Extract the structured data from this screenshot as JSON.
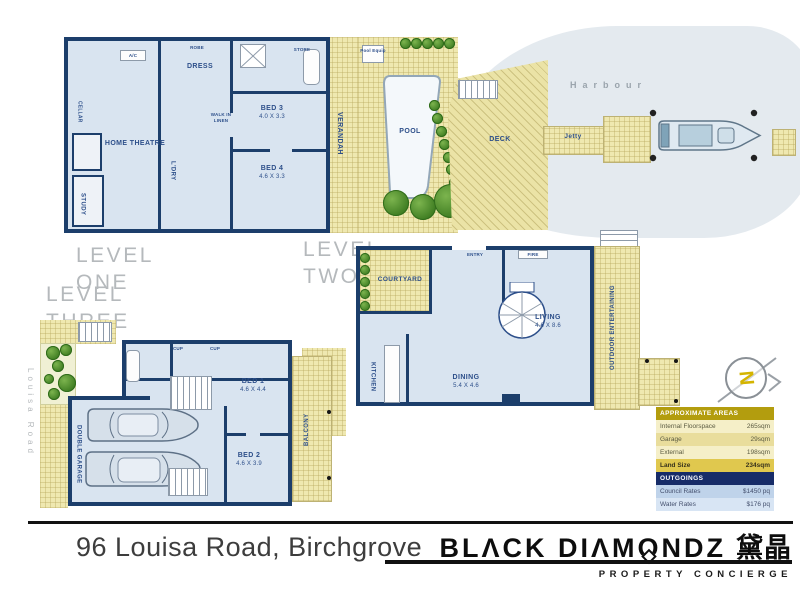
{
  "levels": {
    "one": {
      "caption": [
        "LEVEL",
        "ONE"
      ],
      "rooms": {
        "home_theatre": "HOME THEATRE",
        "study": "STUDY",
        "cellar": "CELLAR",
        "dress": "DRESS",
        "robe": "ROBE",
        "laundry": "L'DRY",
        "walk_in_linen": "WALK IN LINEN",
        "bed3": "BED 3",
        "bed3_dims": "4.0 X 3.3",
        "bed4": "BED 4",
        "bed4_dims": "4.6 X 3.3",
        "store": "STORE",
        "ac": "A/C"
      },
      "outdoor": {
        "verandah": "VERANDAH",
        "pool": "POOL",
        "pool_equip": "Pool Equip",
        "deck": "DECK",
        "harbour": "Harbour",
        "jetty": "Jetty"
      }
    },
    "two": {
      "caption": [
        "LEVEL",
        "TWO"
      ],
      "rooms": {
        "courtyard": "COURTYARD",
        "entry": "ENTRY",
        "fire": "FIRE",
        "kitchen": "KITCHEN",
        "dining": "DINING",
        "dining_dims": "5.4 X 4.6",
        "living": "LIVING",
        "living_dims": "4.6 X 8.6",
        "outdoor_entertaining": "OUTDOOR ENTERTAINING"
      }
    },
    "three": {
      "caption": [
        "LEVEL",
        "THREE"
      ],
      "street": "Louisa Road",
      "rooms": {
        "double_garage": "DOUBLE GARAGE",
        "bed1": "BED 1",
        "bed1_dims": "4.6 X 4.4",
        "bed2": "BED 2",
        "bed2_dims": "4.6 X 3.9",
        "balcony": "BALCONY",
        "cup_a": "CUP",
        "cup_b": "CUP"
      }
    }
  },
  "compass": {
    "label": "N"
  },
  "table": {
    "areas": {
      "title": "APPROXIMATE AREAS",
      "rows": [
        {
          "label": "Internal Floorspace",
          "value": "265sqm"
        },
        {
          "label": "Garage",
          "value": "29sqm"
        },
        {
          "label": "External",
          "value": "198sqm"
        },
        {
          "label": "Land Size",
          "value": "234sqm"
        }
      ]
    },
    "outgoings": {
      "title": "OUTGOINGS",
      "rows": [
        {
          "label": "Council Rates",
          "value": "$1450 pq"
        },
        {
          "label": "Water Rates",
          "value": "$176 pq"
        }
      ]
    }
  },
  "footer": {
    "address": "96 Louisa Road, Birchgrove",
    "brand": {
      "pre": "BLΛCK DIΛM",
      "o": "O",
      "post": "NDZ",
      "cjk": "黛晶",
      "tagline": "PROPERTY CONCIERGE"
    }
  },
  "colors": {
    "wall_navy": "#1c3e6b",
    "interior_blue": "#d9e4f0",
    "outdoor_yellow": "#efe8b0",
    "harbour_grey": "#e4eaef",
    "table_gold": "#b39d0e",
    "table_navy": "#172c68",
    "land_highlight": "#e0c84e"
  }
}
